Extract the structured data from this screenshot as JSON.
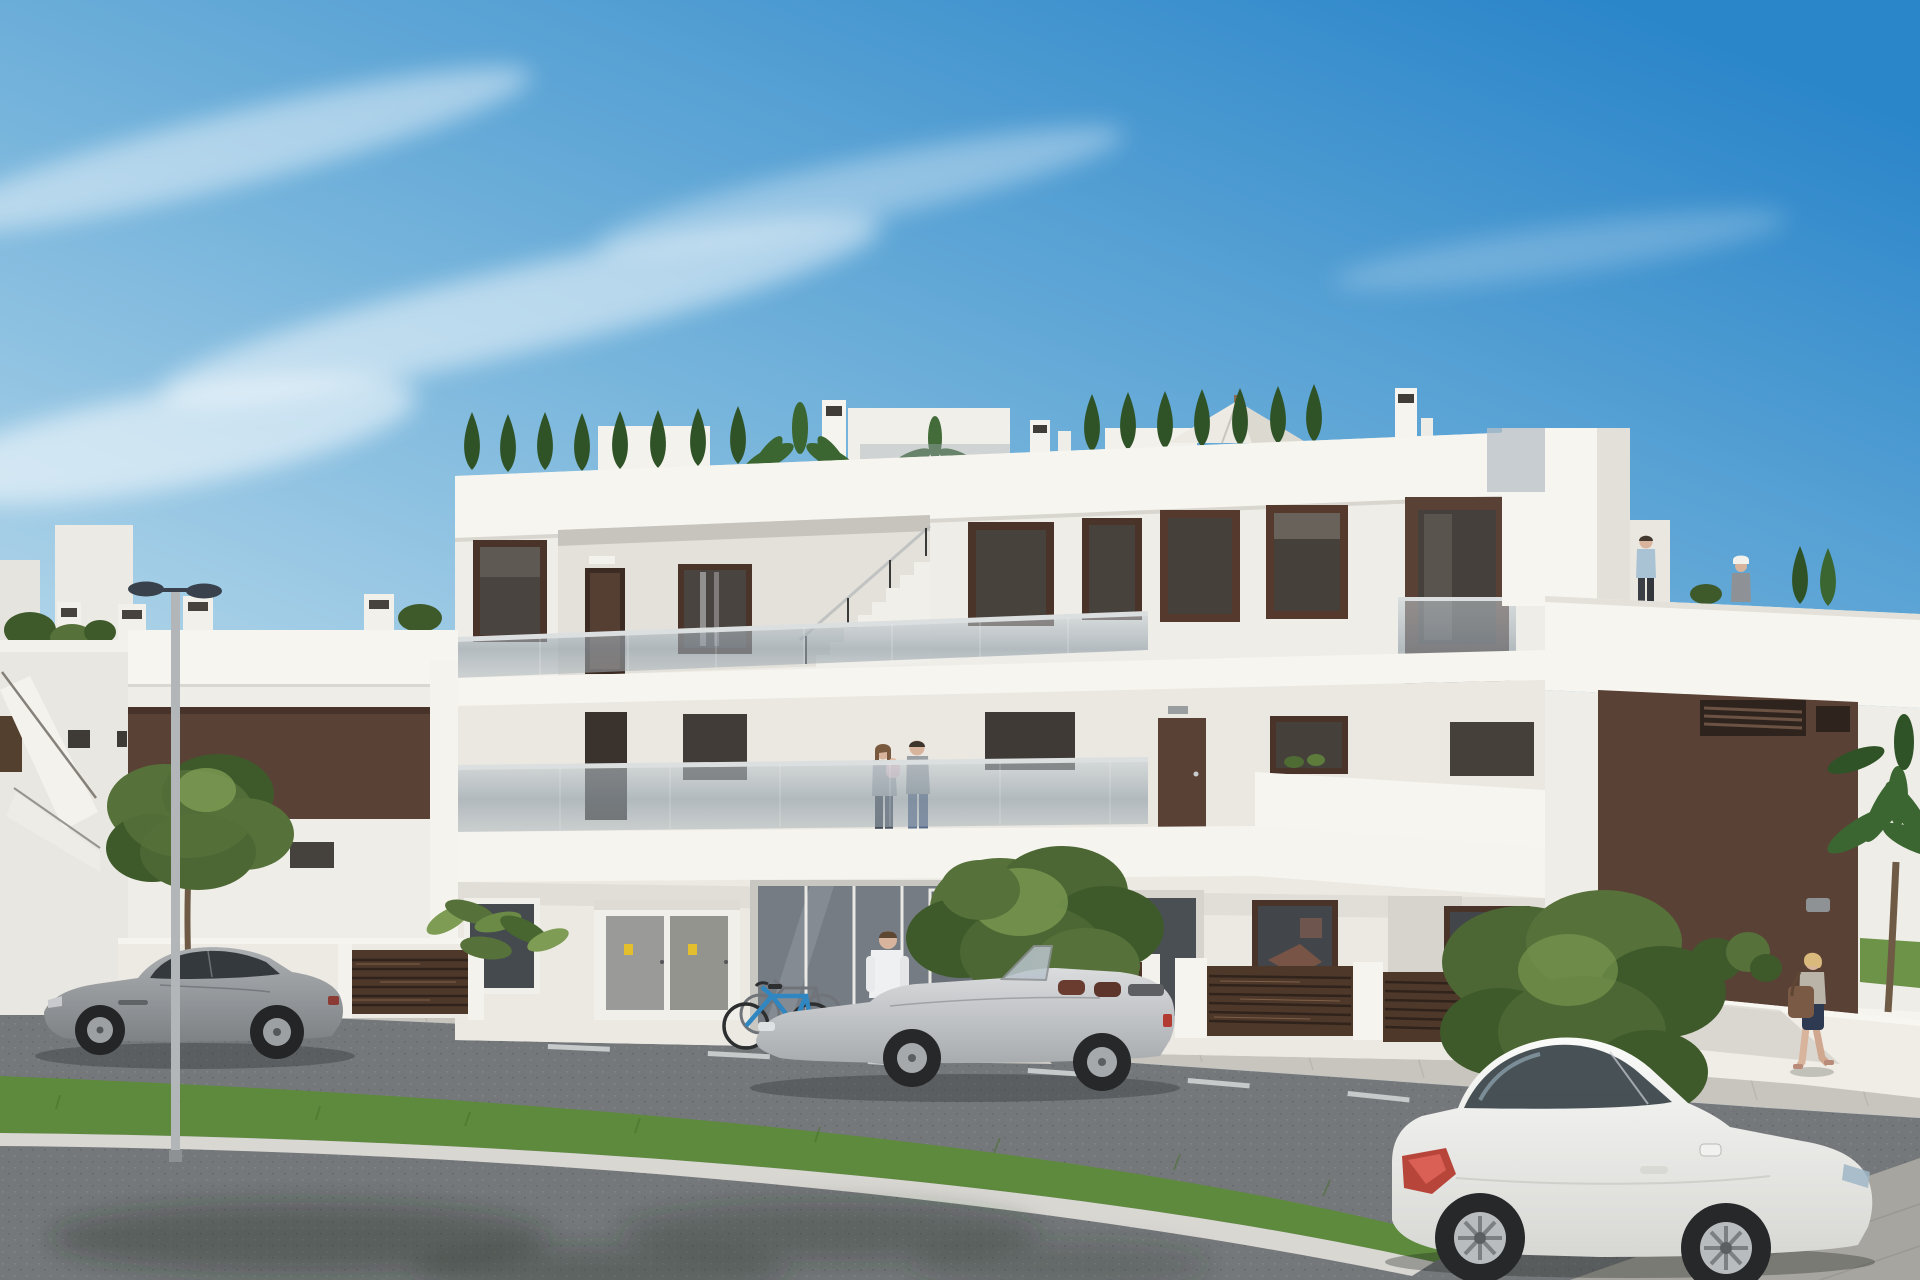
{
  "meta": {
    "type": "architectural-3d-render",
    "description": "Street-view 3D rendering of a modern white three-level apartment building with brown accent panels, glass balcony railings, rooftop terraces with conifers and a white parasol, parked cars (gray sports coupe, silver convertible, white coupe), bicycles at the glass entrance, residents on balconies and roof terrace, a double-head streetlamp, trees, a grass median and asphalt road under a clear blue sky."
  },
  "palette": {
    "sky_top": "#2a85c9",
    "sky_mid": "#6fb0da",
    "sky_horizon": "#d9edf6",
    "cloud": "#ffffff",
    "wall_bright": "#f7f5ef",
    "wall_white": "#efede7",
    "wall_tint": "#eae8e1",
    "wall_shade": "#e3e1da",
    "wall_recess": "#d6d4cd",
    "brown_panel": "#5a4136",
    "brown_dark": "#3f2d22",
    "fence_brown": "#4e382a",
    "frame_brown": "#4a342a",
    "glass_dark": "#4a4440",
    "glass_entry": "#757c83",
    "rail_glass": "#9fabb4",
    "rail_top": "#dcdfe0",
    "sidewalk": "#c8c5be",
    "paver": "#b2afa7",
    "road": "#75787b",
    "road_fore": "#6d7073",
    "curb": "#d8d7d2",
    "paved": "#a7a59f",
    "grass": "#5d8a3c",
    "lawn": "#6c9347",
    "tree": "#56713a",
    "tree_dark": "#3e5a2a",
    "tree_light": "#7e9c54",
    "conifer": "#2f5327",
    "palm": "#3b6631",
    "trunk": "#6f5b45",
    "pit": "#6b5a49",
    "car_gray": "#94979a",
    "car_silver": "#c9cbce",
    "car_white": "#f3f3f1",
    "wheel": "#26282a",
    "rim": "#a6a9ac",
    "taillight": "#b23b32",
    "cabinet": "#9a9a98",
    "sticker": "#e3bf2e",
    "lamp_head": "#39414d",
    "pole": "#b3b6b8",
    "umbrella": "#eceae3",
    "skin": "#d9b49c"
  },
  "scene": {
    "setting": "modern white residential block, street level view, sunny day",
    "vehicles": [
      {
        "name": "gray-sports-coupe",
        "color": "#94979a",
        "position": "left, parked, facing left"
      },
      {
        "name": "silver-convertible",
        "color": "#c9cbce",
        "position": "center, parked, top down, facing left"
      },
      {
        "name": "white-coupe",
        "color": "#f3f3f1",
        "position": "foreground right, facing right"
      }
    ],
    "people": [
      {
        "name": "man-at-entrance",
        "detail": "white shirt, dark trousers, carrying a bag"
      },
      {
        "name": "couple-with-baby",
        "detail": "standing at first-floor glass balcony"
      },
      {
        "name": "man-roof-terrace",
        "detail": "blue shirt, walking on roof terrace"
      },
      {
        "name": "woman-roof-terrace",
        "detail": "white visor, gray top, on roof terrace"
      },
      {
        "name": "woman-walking",
        "detail": "navy skirt, brown shoulder bag, right sidewalk"
      }
    ],
    "objects": [
      "streetlamp-double-head",
      "two-bicycles",
      "rooftop-parasol",
      "rooftop-conifers",
      "palm-trees",
      "street-trees",
      "brown-slatted-fences",
      "utility-cabinets",
      "glass-balustrades",
      "grass-median",
      "lane-markings"
    ]
  }
}
